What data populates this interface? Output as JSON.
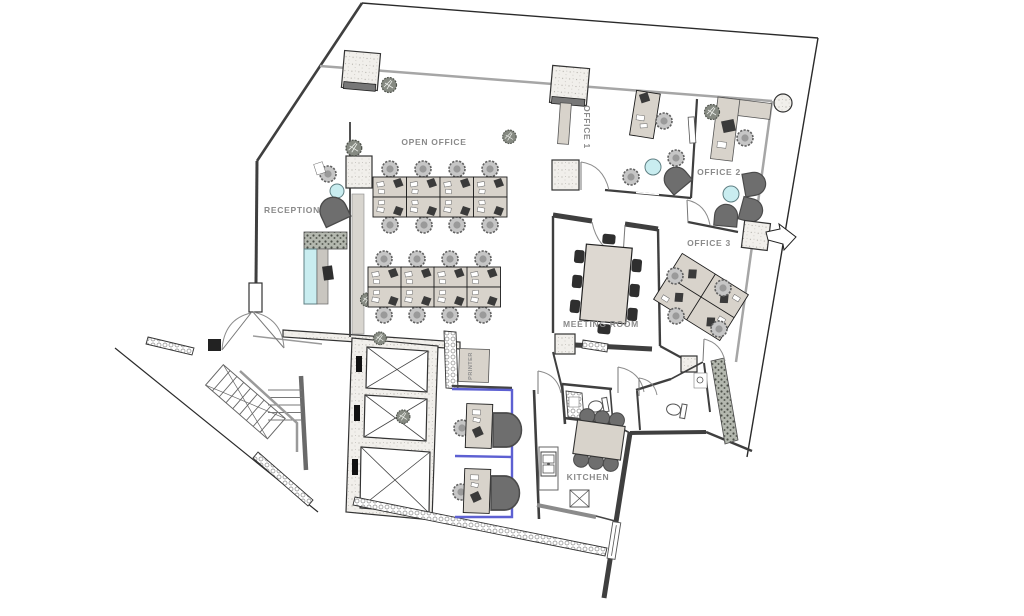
{
  "meta": {
    "drawing_type": "office floor plan"
  },
  "labels": {
    "open_office": "OPEN OFFICE",
    "reception": "RECEPTION",
    "office1": "OFFICE 1",
    "office2": "OFFICE 2",
    "office3": "OFFICE 3",
    "meeting_room": "MEETING ROOM",
    "kitchen": "KITCHEN",
    "printer": "PRINTER"
  },
  "colors": {
    "wall": "#3f3f3f",
    "facade_glass": "#a6a6a6",
    "desk_tan": "#d8d3cb",
    "accent_cyan": "#c9edf0",
    "booth_blue": "#5d60d2",
    "chair_dark": "#6e6e6e",
    "monitor_dark": "#3a3a3a",
    "label_text": "#8a8a8a",
    "concrete": "#efede9"
  }
}
